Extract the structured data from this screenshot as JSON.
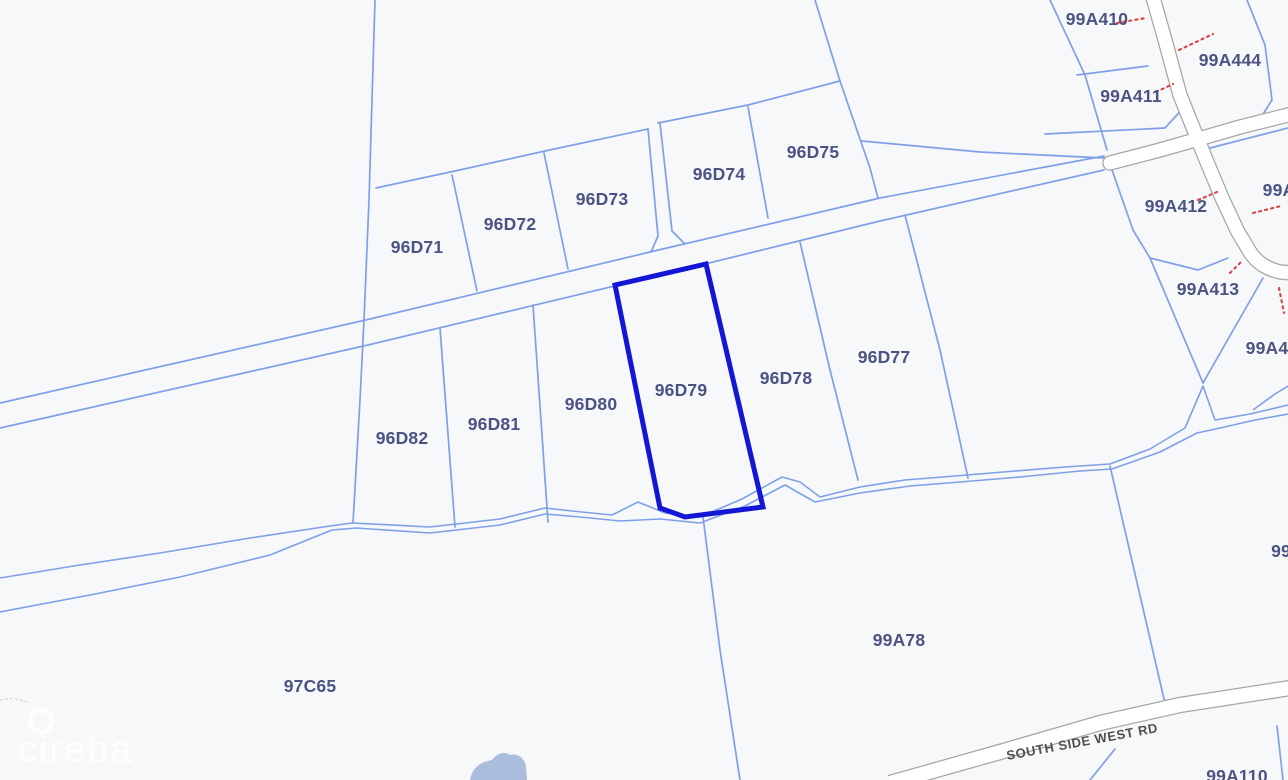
{
  "map": {
    "background_color": "#f7f8f9",
    "parcel_line_color": "#7fa0e8",
    "highlight_color": "#1316d4",
    "label_color": "#4b5382",
    "red_marker_color": "#dc4343",
    "road_fill": "#ffffff",
    "road_casing": "#a6a6a6",
    "pond_color": "#aabddc"
  },
  "parcels": [
    {
      "label": "96D71"
    },
    {
      "label": "96D72"
    },
    {
      "label": "96D73"
    },
    {
      "label": "96D74"
    },
    {
      "label": "96D75"
    },
    {
      "label": "96D77"
    },
    {
      "label": "96D78"
    },
    {
      "label": "96D79",
      "highlighted": true
    },
    {
      "label": "96D80"
    },
    {
      "label": "96D81"
    },
    {
      "label": "96D82"
    },
    {
      "label": "97C65"
    },
    {
      "label": "99A78"
    },
    {
      "label": "99A410"
    },
    {
      "label": "99A411"
    },
    {
      "label": "99A444"
    },
    {
      "label": "99A412"
    },
    {
      "label": "99A413"
    },
    {
      "label": "99A"
    },
    {
      "label": "99A4"
    },
    {
      "label": "99"
    },
    {
      "label": "99A110"
    }
  ],
  "roads": {
    "south_side_west_rd": "SOUTH SIDE WEST RD"
  },
  "watermark": {
    "text": "cireba"
  }
}
